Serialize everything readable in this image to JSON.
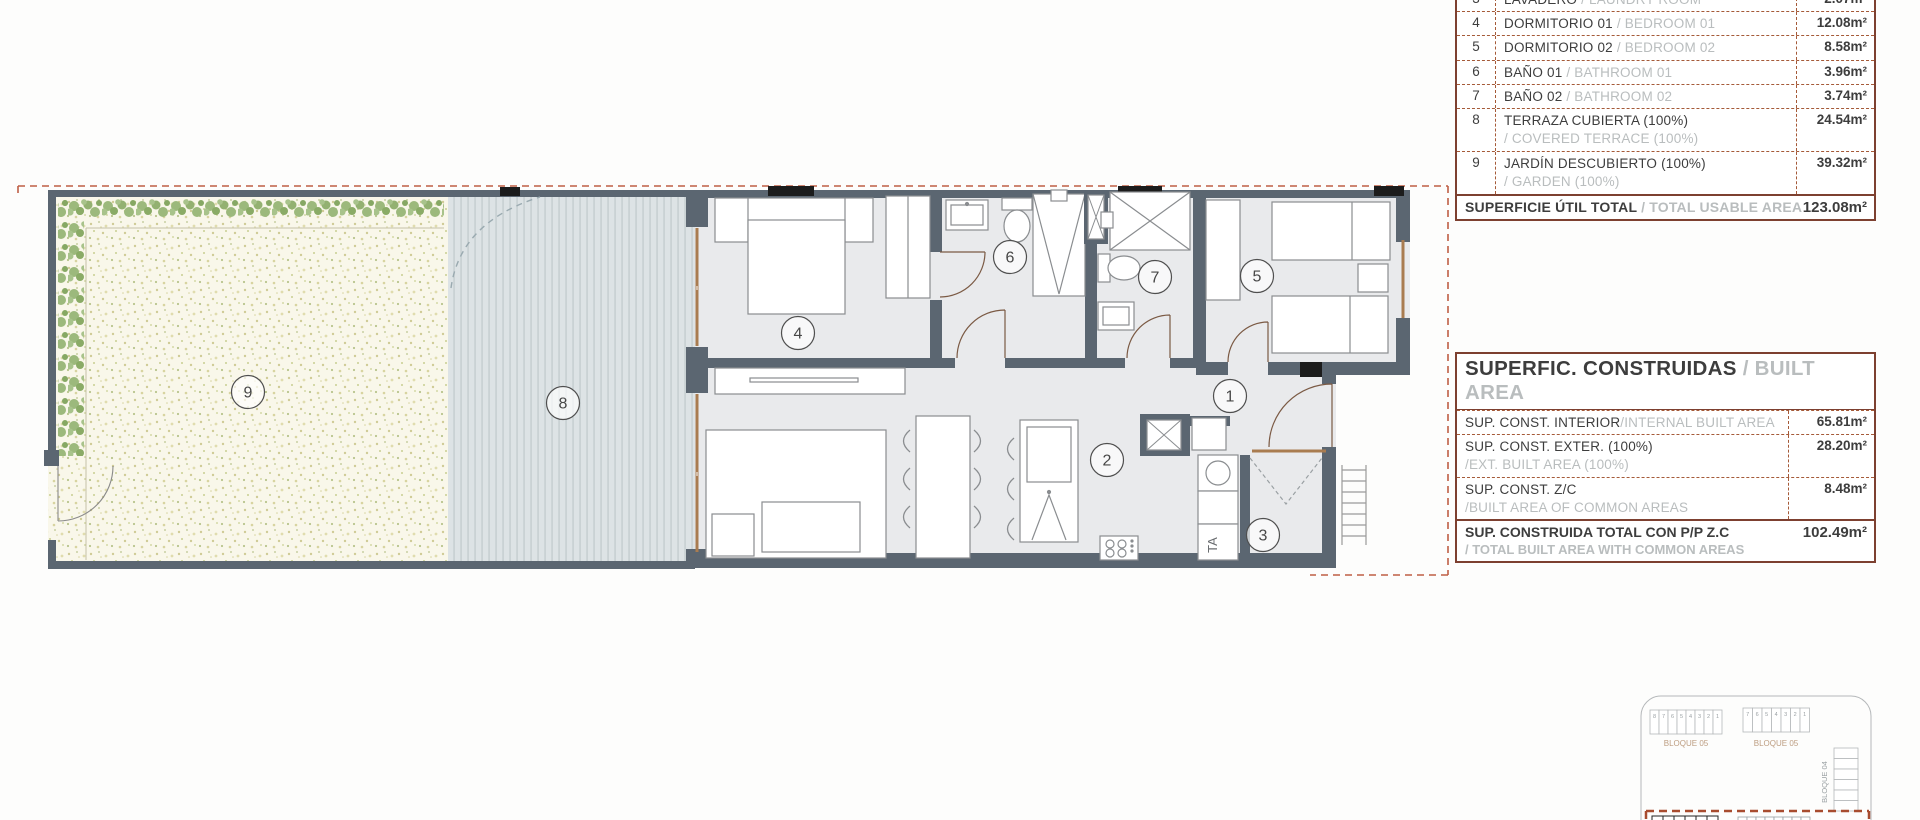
{
  "colors": {
    "table_border": "#7d4030",
    "table_dashed": "#a55a38",
    "grey_translation_text": "#b9bdbe",
    "wall": "#5b6671",
    "boundary_dashed": "#bf5f45",
    "terrace_floor": "#dde3e5",
    "garden_floor": "#f9f7ea",
    "hedge_green": "#8fae6e",
    "window_frame": "#a97c50",
    "interior_floor": "#e9eaec"
  },
  "usable_area_table": {
    "rows": [
      {
        "num": "3",
        "name": "LAVADERO",
        "name_en": "/ LAUNDRY ROOM",
        "value": "2.07m²"
      },
      {
        "num": "4",
        "name": "DORMITORIO 01",
        "name_en": "/ BEDROOM 01",
        "value": "12.08m²"
      },
      {
        "num": "5",
        "name": "DORMITORIO 02",
        "name_en": "/ BEDROOM 02",
        "value": "8.58m²"
      },
      {
        "num": "6",
        "name": "BAÑO 01",
        "name_en": "/ BATHROOM 01",
        "value": "3.96m²"
      },
      {
        "num": "7",
        "name": "BAÑO 02",
        "name_en": "/ BATHROOM 02",
        "value": "3.74m²"
      },
      {
        "num": "8",
        "name": "TERRAZA CUBIERTA (100%)",
        "name_en": "/ COVERED TERRACE (100%)",
        "value": "24.54m²"
      },
      {
        "num": "9",
        "name": "JARDÍN DESCUBIERTO (100%)",
        "name_en": "/ GARDEN (100%)",
        "value": "39.32m²"
      }
    ],
    "total": {
      "label": "SUPERFICIE ÚTIL TOTAL",
      "label_en": "/ TOTAL USABLE AREA",
      "value": "123.08m²"
    }
  },
  "built_area_table": {
    "title": "SUPERFIC. CONSTRUIDAS",
    "title_en": "/ BUILT AREA",
    "rows": [
      {
        "label": "SUP. CONST. INTERIOR",
        "label_en": "/INTERNAL BUILT AREA",
        "value": "65.81m²"
      },
      {
        "label": "SUP. CONST. EXTER. (100%)",
        "label_en": "/EXT. BUILT AREA (100%)",
        "value": "28.20m²"
      },
      {
        "label": "SUP. CONST. Z/C",
        "label_en": "/BUILT AREA OF COMMON AREAS",
        "value": "8.48m²"
      }
    ],
    "total": {
      "label": "SUP. CONSTRUIDA TOTAL CON P/P Z.C",
      "label_en": "/ TOTAL BUILT AREA WITH COMMON AREAS",
      "value": "102.49m²"
    }
  },
  "floor_plan": {
    "rooms": [
      "1",
      "2",
      "3",
      "4",
      "5",
      "6",
      "7",
      "8",
      "9"
    ],
    "washer_label": "TA"
  },
  "key_plan": {
    "left_block_label": "BLOQUE 05",
    "right_block_label": "BLOQUE 05",
    "vertical_block_label": "BLOQUE 04",
    "left_cells": [
      "8",
      "7",
      "6",
      "5",
      "4",
      "3",
      "2",
      "1"
    ],
    "right_cells": [
      "7",
      "6",
      "5",
      "4",
      "3",
      "2",
      "1"
    ]
  }
}
